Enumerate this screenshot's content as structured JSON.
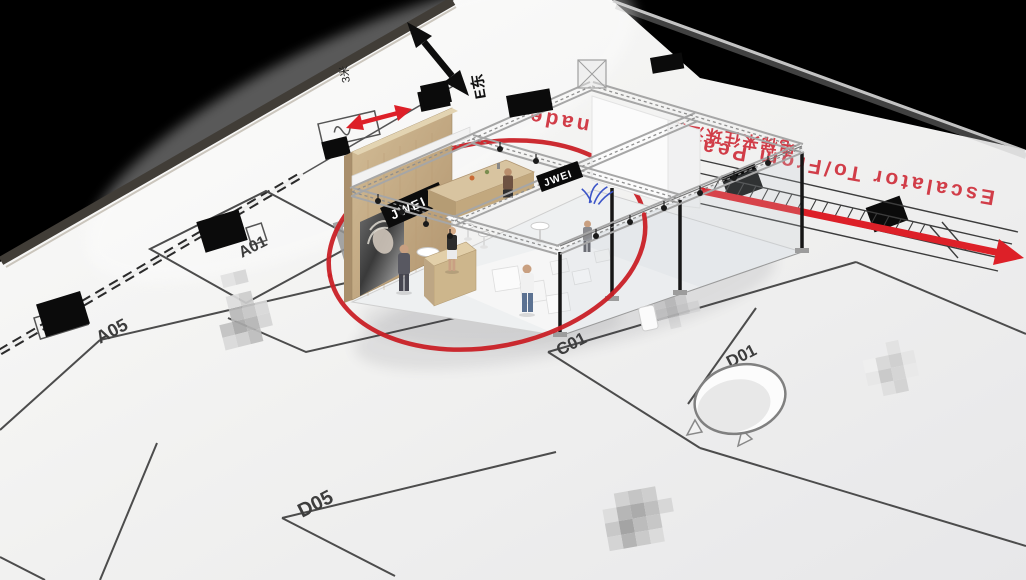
{
  "compass": {
    "east_label": "E东",
    "scale_label": "3米"
  },
  "escalator": {
    "label_en": "Escalator To/From Pearl promenade",
    "label_zh": "电梯来往珠江散步道"
  },
  "booth_render": {
    "fascia_sign": "JWEI",
    "hanging_sign": "JWEI"
  },
  "floor_plan": {
    "hall_letter": "P",
    "booths": [
      {
        "id": "A01"
      },
      {
        "id": "A05"
      },
      {
        "id": "C01"
      },
      {
        "id": "D01"
      },
      {
        "id": "D05"
      }
    ]
  },
  "colors": {
    "background": "#000000",
    "floor": "#f2f2f1",
    "plan_line": "#4c4c4c",
    "highlight_circle_red": "#c92026",
    "arrow_red": "#dd2028",
    "text_red": "#d13d48",
    "wood": "#c9b28d",
    "truss_gray": "#a6a6a6"
  }
}
